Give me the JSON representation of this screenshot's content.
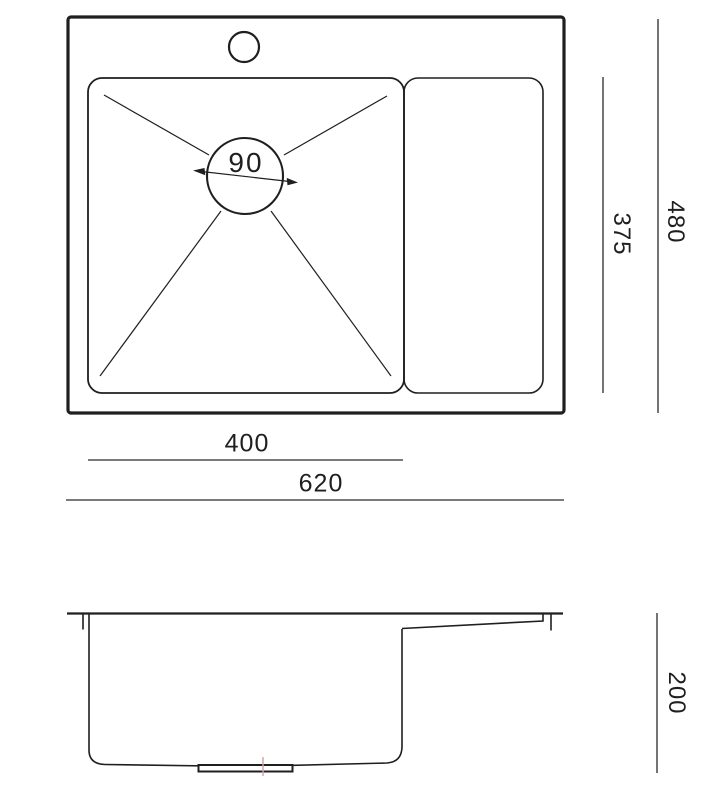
{
  "drawing": {
    "kind": "sink-dimensional-drawing",
    "views": [
      "top-view",
      "side-view"
    ]
  },
  "dimensions": {
    "drain_diameter": "90",
    "bowl_depth": "375",
    "overall_depth": "480",
    "bowl_width": "400",
    "overall_width": "620",
    "sink_height": "200"
  },
  "colors": {
    "line": "#1f1f1f",
    "background": "#ffffff",
    "accent_centerline": "#d9a0a6"
  }
}
